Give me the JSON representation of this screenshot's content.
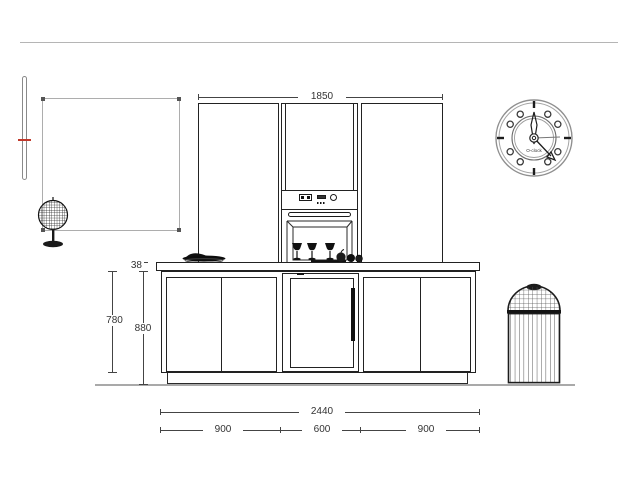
{
  "drawing": {
    "type": "kitchen-elevation",
    "dimensions": {
      "tall_unit_width": "1850",
      "countertop_thickness": "38",
      "base_door_height": "780",
      "worktop_height": "880",
      "total_width": "2440",
      "segment_left": "900",
      "segment_middle": "600",
      "segment_right": "900"
    },
    "clock": {
      "label": "O-clock"
    },
    "colors": {
      "line_dark": "#1f1f1f",
      "line_gray": "#aaaaaa",
      "dimension": "#444444",
      "accent_red": "#c0392b"
    }
  }
}
